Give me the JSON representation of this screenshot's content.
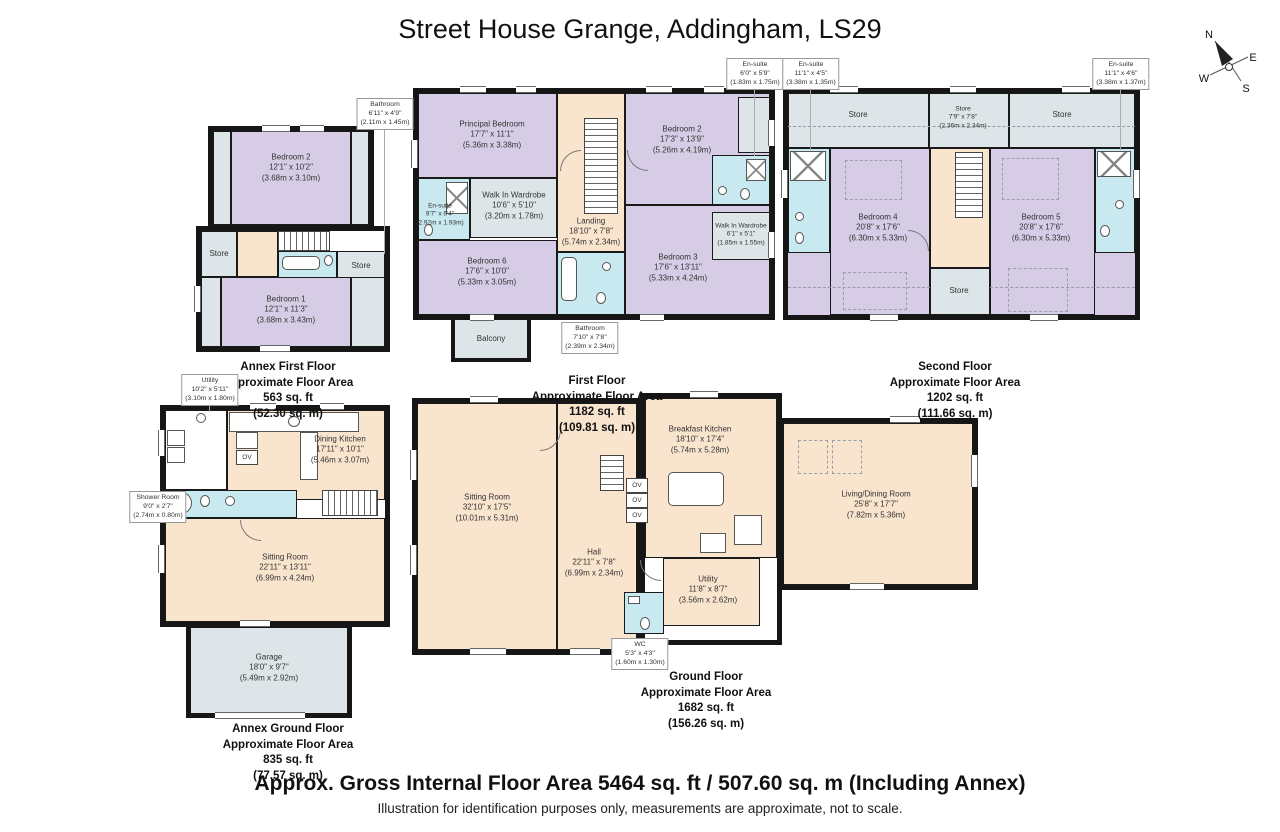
{
  "title": "Street House Grange, Addingham, LS29",
  "compass": {
    "n": "N",
    "e": "E",
    "s": "S",
    "w": "W"
  },
  "labels": {
    "ov": "OV"
  },
  "colors": {
    "bedroom": "#d7cce6",
    "bathroom": "#c9e9f0",
    "circulation": "#f9e4ce",
    "store": "#dee5e8",
    "wall": "#1a1a1a"
  },
  "footer": {
    "area_line": "Approx. Gross Internal Floor Area 5464 sq. ft / 507.60 sq. m (Including Annex)",
    "disclaimer": "Illustration for identification purposes only, measurements are approximate, not to scale."
  },
  "floors": {
    "annex_first": {
      "area": [
        "Annex First Floor",
        "Approximate Floor Area",
        "563 sq. ft",
        "(52.30 sq. m)"
      ],
      "rooms": {
        "bedroom2": {
          "name": "Bedroom 2",
          "ft": "12'1\" x 10'2\"",
          "m": "(3.68m x 3.10m)"
        },
        "bedroom1": {
          "name": "Bedroom 1",
          "ft": "12'1\" x 11'3\"",
          "m": "(3.68m x 3.43m)"
        },
        "store_left": {
          "name": "Store"
        },
        "store_right": {
          "name": "Store"
        }
      },
      "callouts": {
        "bathroom": {
          "name": "Bathroom",
          "ft": "6'11\" x 4'9\"",
          "m": "(2.11m x 1.45m)"
        }
      }
    },
    "first": {
      "area": [
        "First Floor",
        "Approximate Floor Area",
        "1182 sq. ft",
        "(109.81 sq. m)"
      ],
      "rooms": {
        "principal_bedroom": {
          "name": "Principal Bedroom",
          "ft": "17'7\" x 11'1\"",
          "m": "(5.36m x 3.38m)"
        },
        "ensuite": {
          "name": "En-suite",
          "ft": "9'7\" x 6'4\"",
          "m": "(2.92m x 1.93m)"
        },
        "walk_in_wardrobe": {
          "name": "Walk In Wardrobe",
          "ft": "10'6\" x 5'10\"",
          "m": "(3.20m x 1.78m)"
        },
        "landing": {
          "name": "Landing",
          "ft": "18'10\" x 7'8\"",
          "m": "(5.74m x 2.34m)"
        },
        "bedroom2": {
          "name": "Bedroom 2",
          "ft": "17'3\" x 13'9\"",
          "m": "(5.26m x 4.19m)"
        },
        "walk_in_wardrobe2": {
          "name": "Walk In Wardrobe",
          "ft": "6'1\" x 5'1\"",
          "m": "(1.85m x 1.55m)"
        },
        "bedroom3": {
          "name": "Bedroom 3",
          "ft": "17'6\" x 13'11\"",
          "m": "(5.33m x 4.24m)"
        },
        "bedroom6": {
          "name": "Bedroom 6",
          "ft": "17'6\" x 10'0\"",
          "m": "(5.33m x 3.05m)"
        },
        "balcony": {
          "name": "Balcony"
        }
      },
      "callouts": {
        "ensuite_top": {
          "name": "En-suite",
          "ft": "6'0\" x 5'9\"",
          "m": "(1.83m x 1.75m)"
        },
        "bathroom": {
          "name": "Bathroom",
          "ft": "7'10\" x 7'8\"",
          "m": "(2.39m x 2.34m)"
        }
      }
    },
    "second": {
      "area": [
        "Second Floor",
        "Approximate Floor Area",
        "1202 sq. ft",
        "(111.66 sq. m)"
      ],
      "rooms": {
        "store_left": {
          "name": "Store"
        },
        "store_mid": {
          "name": "Store",
          "ft": "7'9\" x 7'8\"",
          "m": "(2.36m x 2.34m)"
        },
        "store_right": {
          "name": "Store"
        },
        "bedroom4": {
          "name": "Bedroom 4",
          "ft": "20'8\" x 17'6\"",
          "m": "(6.30m x 5.33m)"
        },
        "bedroom5": {
          "name": "Bedroom 5",
          "ft": "20'8\" x 17'6\"",
          "m": "(6.30m x 5.33m)"
        },
        "store_bottom": {
          "name": "Store"
        }
      },
      "callouts": {
        "ensuite_left": {
          "name": "En-suite",
          "ft": "11'1\" x 4'5\"",
          "m": "(3.38m x 1.35m)"
        },
        "ensuite_right": {
          "name": "En-suite",
          "ft": "11'1\" x 4'6\"",
          "m": "(3.38m x 1.37m)"
        }
      }
    },
    "annex_ground": {
      "area": [
        "Annex Ground Floor",
        "Approximate Floor Area",
        "835 sq. ft",
        "(77.57 sq. m)"
      ],
      "rooms": {
        "dining_kitchen": {
          "name": "Dining Kitchen",
          "ft": "17'11\" x 10'1\"",
          "m": "(5.46m x 3.07m)"
        },
        "sitting_room": {
          "name": "Sitting Room",
          "ft": "22'11\" x 13'11\"",
          "m": "(6.99m x 4.24m)"
        },
        "garage": {
          "name": "Garage",
          "ft": "18'0\" x 9'7\"",
          "m": "(5.49m x 2.92m)"
        }
      },
      "callouts": {
        "utility": {
          "name": "Utility",
          "ft": "10'2\" x 5'11\"",
          "m": "(3.10m x 1.80m)"
        },
        "shower_room": {
          "name": "Shower Room",
          "ft": "9'0\" x 2'7\"",
          "m": "(2.74m x 0.80m)"
        }
      }
    },
    "ground": {
      "area": [
        "Ground Floor",
        "Approximate Floor Area",
        "1682 sq. ft",
        "(156.26 sq. m)"
      ],
      "rooms": {
        "sitting_room": {
          "name": "Sitting Room",
          "ft": "32'10\" x 17'5\"",
          "m": "(10.01m x 5.31m)"
        },
        "hall": {
          "name": "Hall",
          "ft": "22'11\" x 7'8\"",
          "m": "(6.99m x 2.34m)"
        },
        "breakfast_kitchen": {
          "name": "Breakfast Kitchen",
          "ft": "18'10\" x 17'4\"",
          "m": "(5.74m x 5.28m)"
        },
        "living_dining": {
          "name": "Living/Dining Room",
          "ft": "25'8\" x 17'7\"",
          "m": "(7.82m x 5.36m)"
        },
        "utility": {
          "name": "Utility",
          "ft": "11'8\" x 8'7\"",
          "m": "(3.56m x 2.62m)"
        }
      },
      "callouts": {
        "wc": {
          "name": "WC",
          "ft": "5'3\" x 4'3\"",
          "m": "(1.60m x 1.30m)"
        }
      }
    }
  }
}
